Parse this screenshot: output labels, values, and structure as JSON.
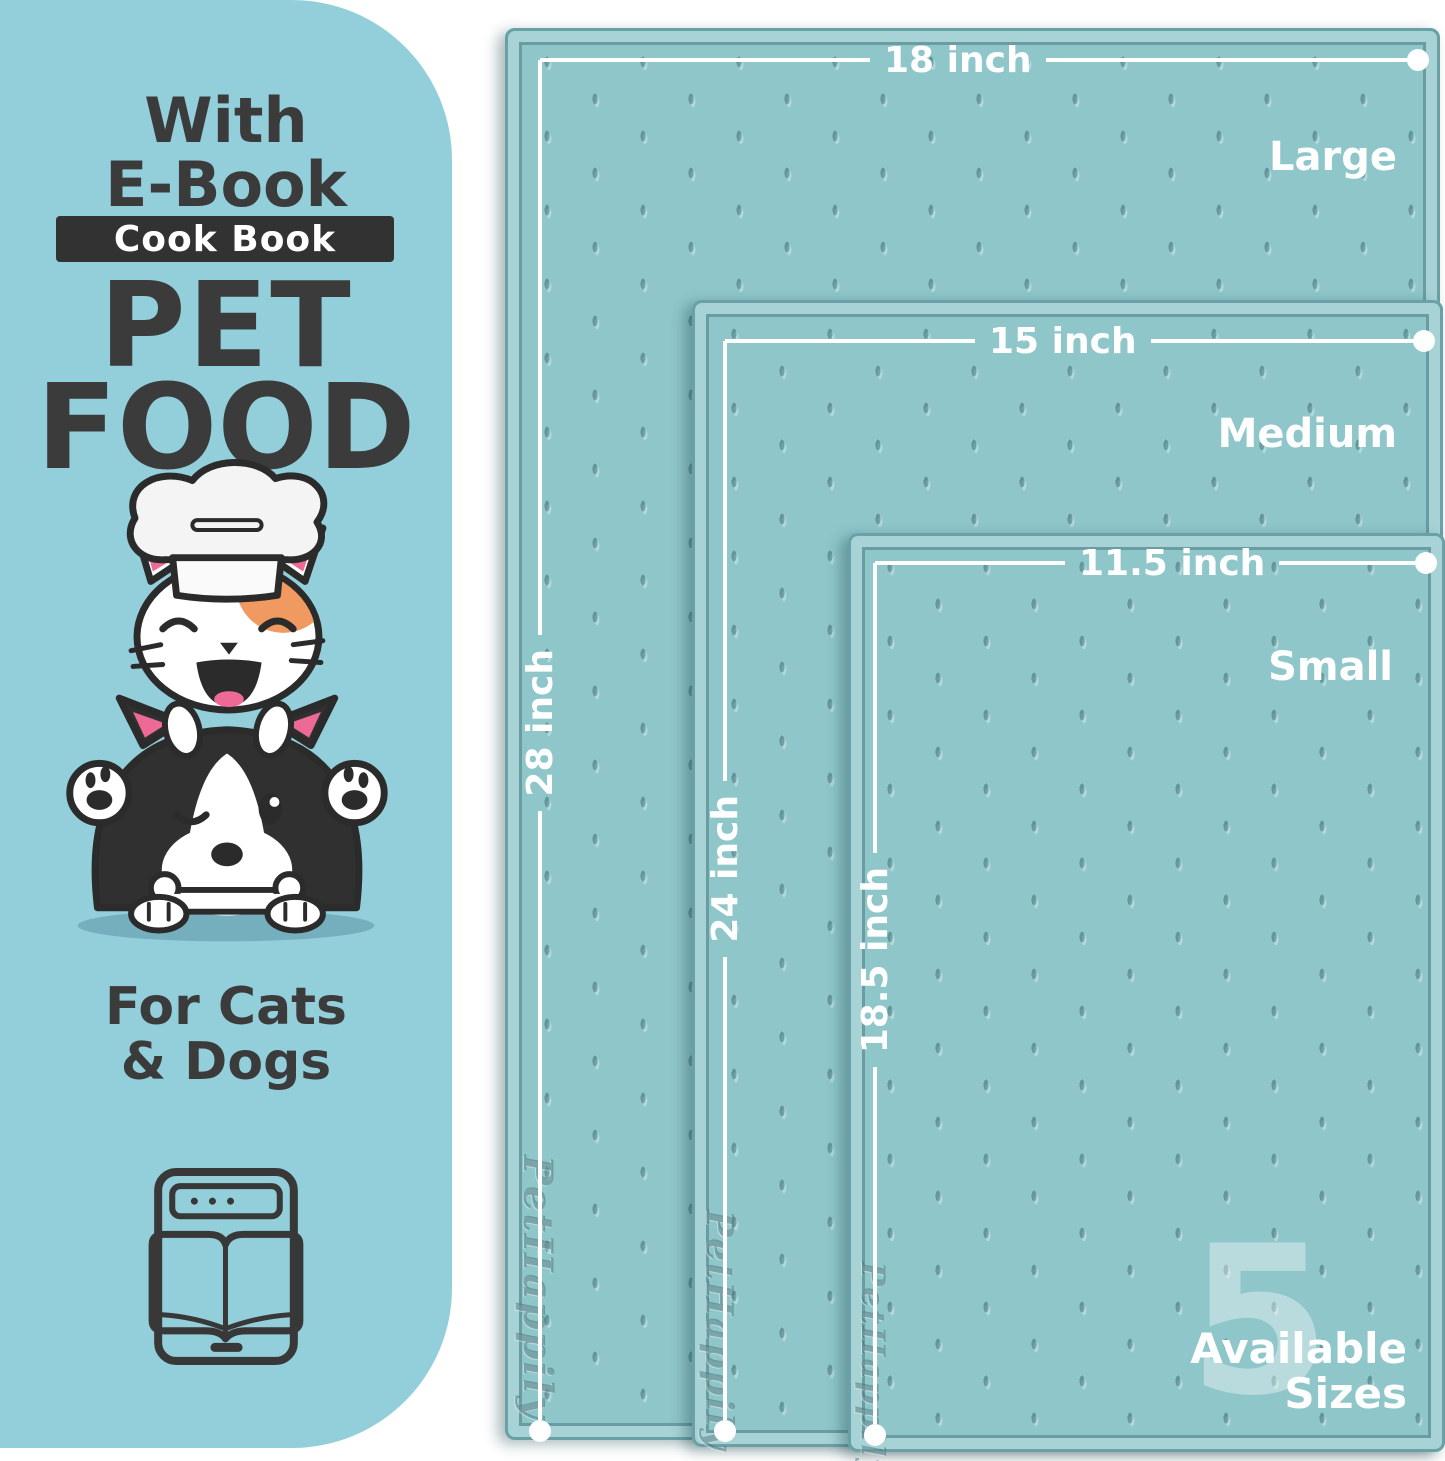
{
  "left_panel": {
    "line1": "With",
    "line2": "E-Book",
    "badge": "Cook Book",
    "title_line1": "PET",
    "title_line2": "FOOD",
    "audience_line1": "For Cats",
    "audience_line2": "& Dogs"
  },
  "mats": [
    {
      "size_name": "Large",
      "width_label": "18 inch",
      "height_label": "28 inch"
    },
    {
      "size_name": "Medium",
      "width_label": "15 inch",
      "height_label": "24 inch"
    },
    {
      "size_name": "Small",
      "width_label": "11.5 inch",
      "height_label": "18.5 inch"
    }
  ],
  "availability": {
    "count": "5",
    "word1": "Available",
    "word2": "Sizes"
  },
  "brand_embossed": "PetHappily",
  "icons": {
    "illustration": "cat-dog-chef-illustration",
    "ebook": "ebook-tablet-icon"
  },
  "colors": {
    "panel_bg": "#93cfdb",
    "mat_surface": "#8ec6ca",
    "mat_rim_light": "#a7d3d6",
    "mat_rim_dark": "#69a1a6",
    "text_dark": "#3b3b3c",
    "badge_bg": "#323232",
    "measure_white": "#ffffff",
    "accent_pink": "#ee6a96",
    "accent_orange": "#f09a62"
  }
}
